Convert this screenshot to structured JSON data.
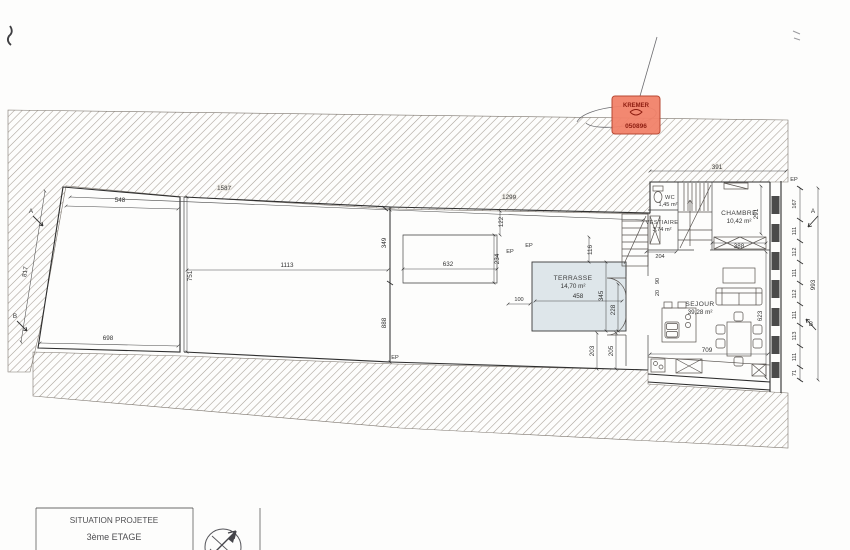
{
  "stamp": {
    "name": "KREMER",
    "number": "050896"
  },
  "title_block": {
    "row1": "SITUATION PROJETEE",
    "row2": "3ème ETAGE",
    "row3": "ECHELLE 1/100"
  },
  "rooms": {
    "terrasse": {
      "name": "TERRASSE",
      "area": "14,70 m²"
    },
    "sejour": {
      "name": "SEJOUR",
      "area": "39,28 m²"
    },
    "chambre": {
      "name": "CHAMBRE",
      "area": "10,42 m²"
    },
    "wc": {
      "name": "WC",
      "area": "1,45 m²"
    },
    "vestiaire": {
      "name": "VESTIAIRE",
      "area": "3,74 m²"
    }
  },
  "dims": {
    "left_room_top": "548",
    "left_room_bottom": "698",
    "left_room_right": "751",
    "left_room_diag": "817",
    "mid_room_width": "1113",
    "mid_right_upper": "349",
    "mid_right_lower": "888",
    "top_run_left": "1587",
    "top_run_right": "1299",
    "skylight_width": "632",
    "skylight_height": "234",
    "skylight_offset": "122",
    "terrasse_width": "458",
    "terrasse_height": "345",
    "terrasse_right": "228",
    "terrasse_top": "116",
    "terrasse_left": "100",
    "door_left": "203",
    "door_right": "205",
    "vestiaire_width": "204",
    "chambre_width": "388",
    "chambre_height": "291",
    "sejour_width": "709",
    "sejour_height": "623",
    "stair_a": "90",
    "stair_b": "20",
    "top_right_width": "391",
    "facade_total": "993",
    "facade_segments": [
      "167",
      "111",
      "112",
      "111",
      "112",
      "111",
      "113",
      "111",
      "71"
    ]
  },
  "markers": {
    "section_a": "A",
    "section_b": "B",
    "ep": "EP"
  },
  "colors": {
    "stamp_fill": "#f2826a",
    "terrasse_fill": "#dee6ea",
    "hatch": "#a59d94"
  }
}
